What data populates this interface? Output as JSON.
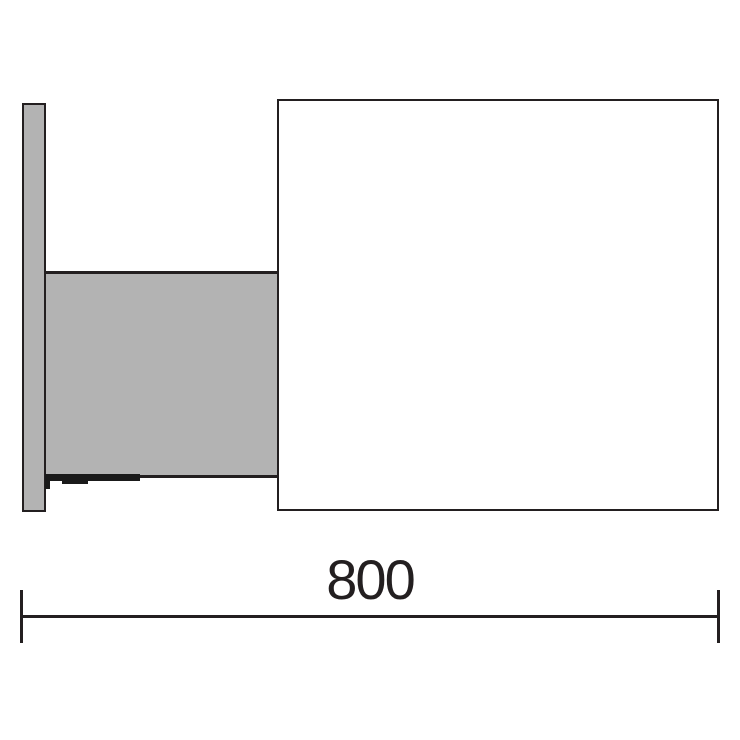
{
  "diagram": {
    "type": "technical-dimension-drawing",
    "dimension": {
      "value": "800"
    },
    "colors": {
      "outline": "#231f20",
      "fill_gray": "#b3b3b3",
      "detail_black": "#1a1a1a",
      "background": "#ffffff"
    }
  }
}
